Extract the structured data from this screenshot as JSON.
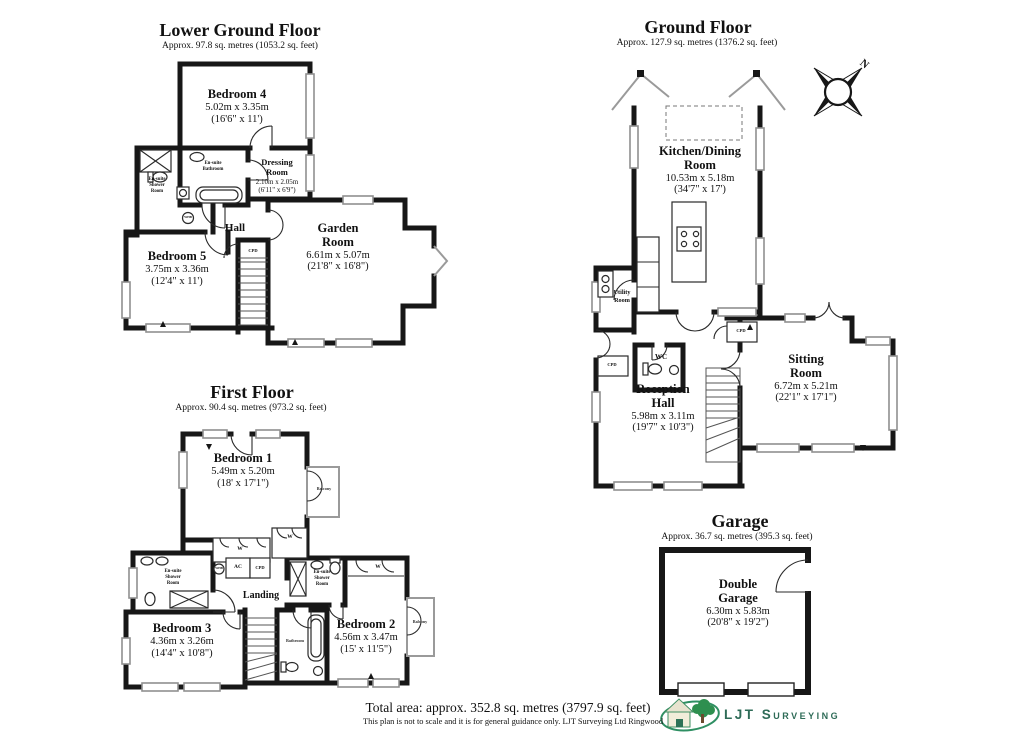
{
  "meta": {
    "background": "#ffffff",
    "wall_color": "#171717",
    "accent_green": "#2e7d5f"
  },
  "floors": {
    "lower_ground": {
      "title": "Lower Ground Floor",
      "subtitle": "Approx. 97.8 sq. metres (1053.2 sq. feet)",
      "rooms": {
        "bedroom4": {
          "name": "Bedroom 4",
          "metric": "5.02m x 3.35m",
          "imperial": "(16'6\" x 11')"
        },
        "dressing_room": {
          "line1": "Dressing",
          "line2": "Room",
          "metric": "2.10m x 2.05m",
          "imperial": "(6'11\" x 6'9\")"
        },
        "hall": {
          "name": "Hall"
        },
        "bedroom5": {
          "name": "Bedroom 5",
          "metric": "3.75m x 3.36m",
          "imperial": "(12'4\" x 11')"
        },
        "garden_room": {
          "line1": "Garden",
          "line2": "Room",
          "metric": "6.61m x 5.07m",
          "imperial": "(21'8\" x 16'8\")"
        },
        "ensuite_shower": {
          "line1": "En-suite",
          "line2": "Shower",
          "line3": "Room"
        },
        "ensuite_bathroom": {
          "line1": "En-suite",
          "line2": "Bathroom"
        }
      }
    },
    "ground": {
      "title": "Ground Floor",
      "subtitle": "Approx. 127.9 sq. metres (1376.2 sq. feet)",
      "compass": "N",
      "rooms": {
        "kitchen_dining": {
          "line1": "Kitchen/Dining",
          "line2": "Room",
          "metric": "10.53m x 5.18m",
          "imperial": "(34'7\" x 17')"
        },
        "utility": {
          "line1": "Utility",
          "line2": "Room"
        },
        "wc": {
          "name": "WC"
        },
        "reception_hall": {
          "line1": "Reception",
          "line2": "Hall",
          "metric": "5.98m x 3.11m",
          "imperial": "(19'7\" x 10'3\")"
        },
        "sitting_room": {
          "line1": "Sitting",
          "line2": "Room",
          "metric": "6.72m x 5.21m",
          "imperial": "(22'1\" x 17'1\")"
        }
      }
    },
    "first": {
      "title": "First Floor",
      "subtitle": "Approx. 90.4 sq. metres (973.2 sq. feet)",
      "rooms": {
        "bedroom1": {
          "name": "Bedroom 1",
          "metric": "5.49m x 5.20m",
          "imperial": "(18' x 17'1\")"
        },
        "bedroom2": {
          "name": "Bedroom 2",
          "metric": "4.56m x 3.47m",
          "imperial": "(15' x 11'5\")"
        },
        "bedroom3": {
          "name": "Bedroom 3",
          "metric": "4.36m x 3.26m",
          "imperial": "(14'4\" x 10'8\")"
        },
        "landing": {
          "name": "Landing"
        },
        "bathroom": {
          "name": "Bathroom"
        },
        "ensuite_shower": {
          "line1": "En-suite",
          "line2": "Shower",
          "line3": "Room"
        }
      }
    },
    "garage": {
      "title": "Garage",
      "subtitle": "Approx. 36.7 sq. metres (395.3 sq. feet)",
      "rooms": {
        "double_garage": {
          "line1": "Double",
          "line2": "Garage",
          "metric": "6.30m x 5.83m",
          "imperial": "(20'8\" x 19'2\")"
        }
      }
    }
  },
  "labels": {
    "cpd": "CPD",
    "wardrobe": "W",
    "airing_cupboard": "AC",
    "whb": "WHB",
    "balcony": "Balcony"
  },
  "footer": {
    "total_area": "Total area: approx. 352.8 sq. metres (3797.9 sq. feet)",
    "disclaimer": "This plan is not to scale and it is for general guidance only. LJT Surveying Ltd Ringwood",
    "logo_text": "LJT Surveying"
  }
}
